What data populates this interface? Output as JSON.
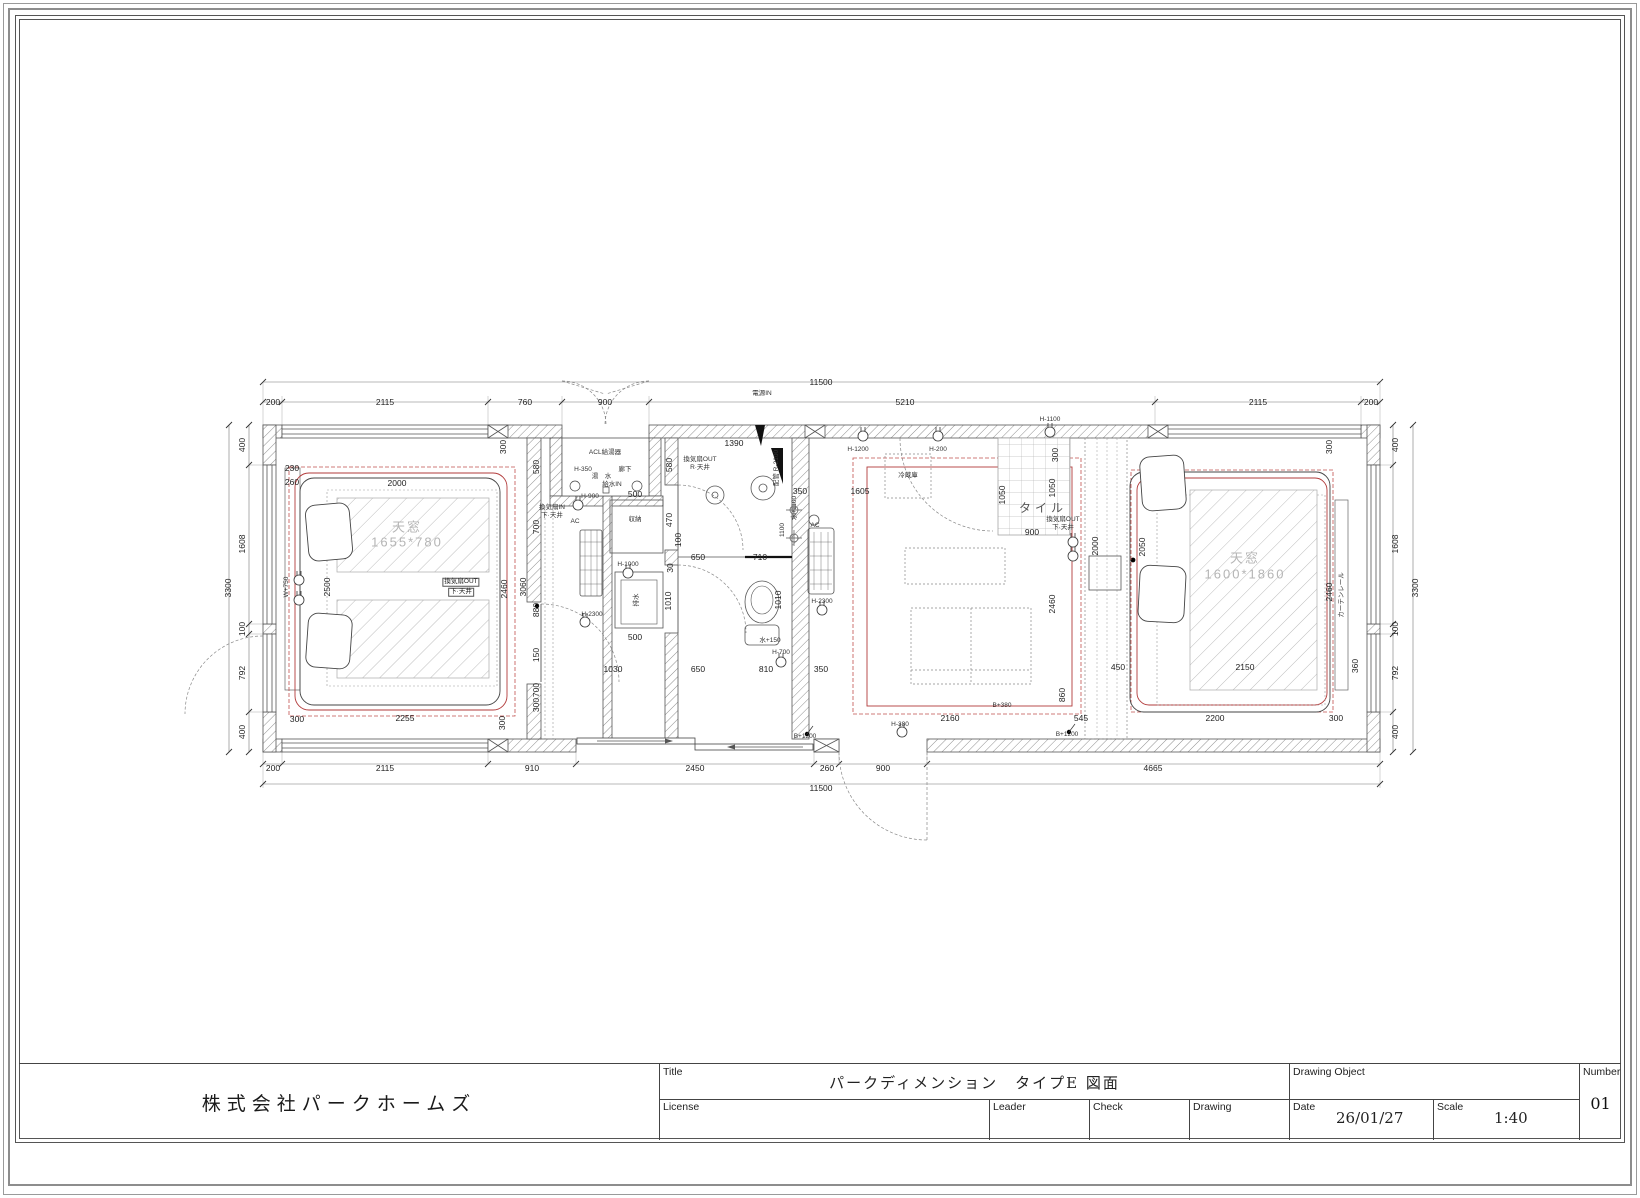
{
  "title_block": {
    "company": "株式会社パークホームズ",
    "title_label": "Title",
    "title": "パークディメンション　タイプE 図面",
    "license_label": "License",
    "leader_label": "Leader",
    "check_label": "Check",
    "drawing_label": "Drawing",
    "drawing_object_label": "Drawing Object",
    "date_label": "Date",
    "date_value": "26/01/27",
    "scale_label": "Scale",
    "scale_value": "1:40",
    "number_label": "Number",
    "number_value": "01"
  },
  "colors": {
    "wall_line": "#555555",
    "dim_text": "#222222",
    "ceiling_red": "#b23b3b",
    "glass_hatch": "#b9b9b9"
  },
  "plan": {
    "annotations": [
      {
        "t": "11500",
        "x": 616,
        "y": 22,
        "c": "d"
      },
      {
        "t": "200",
        "x": 68,
        "y": 42,
        "c": "d"
      },
      {
        "t": "2115",
        "x": 180,
        "y": 42,
        "c": "d"
      },
      {
        "t": "760",
        "x": 320,
        "y": 42,
        "c": "d"
      },
      {
        "t": "900",
        "x": 400,
        "y": 42,
        "c": "d"
      },
      {
        "t": "5210",
        "x": 700,
        "y": 42,
        "c": "d"
      },
      {
        "t": "2115",
        "x": 1053,
        "y": 42,
        "c": "d"
      },
      {
        "t": "200",
        "x": 1166,
        "y": 42,
        "c": "d"
      },
      {
        "t": "200",
        "x": 68,
        "y": 408,
        "c": "d"
      },
      {
        "t": "2115",
        "x": 180,
        "y": 408,
        "c": "d"
      },
      {
        "t": "910",
        "x": 327,
        "y": 408,
        "c": "d"
      },
      {
        "t": "2450",
        "x": 490,
        "y": 408,
        "c": "d"
      },
      {
        "t": "260",
        "x": 622,
        "y": 408,
        "c": "d"
      },
      {
        "t": "900",
        "x": 678,
        "y": 408,
        "c": "d"
      },
      {
        "t": "4665",
        "x": 948,
        "y": 408,
        "c": "d"
      },
      {
        "t": "11500",
        "x": 616,
        "y": 428,
        "c": "d"
      },
      {
        "t": "3300",
        "x": 23,
        "y": 228,
        "c": "dr"
      },
      {
        "t": "400",
        "x": 37,
        "y": 85,
        "c": "dr"
      },
      {
        "t": "1608",
        "x": 37,
        "y": 184,
        "c": "dr"
      },
      {
        "t": "100",
        "x": 37,
        "y": 269,
        "c": "dr"
      },
      {
        "t": "792",
        "x": 37,
        "y": 313,
        "c": "dr"
      },
      {
        "t": "400",
        "x": 37,
        "y": 372,
        "c": "dr"
      },
      {
        "t": "400",
        "x": 1190,
        "y": 85,
        "c": "dr"
      },
      {
        "t": "1608",
        "x": 1190,
        "y": 184,
        "c": "dr"
      },
      {
        "t": "100",
        "x": 1190,
        "y": 269,
        "c": "dr"
      },
      {
        "t": "792",
        "x": 1190,
        "y": 313,
        "c": "dr"
      },
      {
        "t": "400",
        "x": 1190,
        "y": 372,
        "c": "dr"
      },
      {
        "t": "3300",
        "x": 1210,
        "y": 228,
        "c": "dr"
      },
      {
        "t": "230",
        "x": 87,
        "y": 108,
        "c": "d"
      },
      {
        "t": "260",
        "x": 87,
        "y": 122,
        "c": "d"
      },
      {
        "t": "2000",
        "x": 192,
        "y": 123,
        "c": "d"
      },
      {
        "t": "2500",
        "x": 122,
        "y": 227,
        "c": "dr"
      },
      {
        "t": "2255",
        "x": 200,
        "y": 358,
        "c": "d"
      },
      {
        "t": "300",
        "x": 92,
        "y": 359,
        "c": "d"
      },
      {
        "t": "300",
        "x": 297,
        "y": 363,
        "c": "dr"
      },
      {
        "t": "300",
        "x": 298,
        "y": 87,
        "c": "dr"
      },
      {
        "t": "2460",
        "x": 299,
        "y": 229,
        "c": "dr"
      },
      {
        "t": "3060",
        "x": 318,
        "y": 227,
        "c": "dr"
      },
      {
        "t": "880",
        "x": 331,
        "y": 250,
        "c": "dr"
      },
      {
        "t": "580",
        "x": 331,
        "y": 107,
        "c": "dr"
      },
      {
        "t": "700",
        "x": 331,
        "y": 167,
        "c": "dr"
      },
      {
        "t": "150",
        "x": 331,
        "y": 295,
        "c": "dr"
      },
      {
        "t": "700",
        "x": 331,
        "y": 330,
        "c": "dr"
      },
      {
        "t": "300",
        "x": 331,
        "y": 345,
        "c": "dr"
      },
      {
        "t": "天窓",
        "x": 202,
        "y": 167,
        "c": "g"
      },
      {
        "t": "1655*780",
        "x": 202,
        "y": 182,
        "c": "g"
      },
      {
        "t": "換気扇OUT",
        "x": 256,
        "y": 222,
        "c": "b"
      },
      {
        "t": "下·天井",
        "x": 256,
        "y": 232,
        "c": "b"
      },
      {
        "t": "W+750",
        "x": 82,
        "y": 227,
        "c": "tr"
      },
      {
        "t": "ACL給湯器",
        "x": 400,
        "y": 93,
        "c": "t"
      },
      {
        "t": "H-350",
        "x": 378,
        "y": 110,
        "c": "t"
      },
      {
        "t": "湯",
        "x": 390,
        "y": 117,
        "c": "t"
      },
      {
        "t": "水",
        "x": 403,
        "y": 117,
        "c": "t"
      },
      {
        "t": "廊下",
        "x": 420,
        "y": 110,
        "c": "t"
      },
      {
        "t": "給水IN",
        "x": 407,
        "y": 125,
        "c": "t"
      },
      {
        "t": "電源IN",
        "x": 557,
        "y": 34,
        "c": "t"
      },
      {
        "t": "H-900",
        "x": 385,
        "y": 137,
        "c": "t"
      },
      {
        "t": "500",
        "x": 430,
        "y": 134,
        "c": "d"
      },
      {
        "t": "収納",
        "x": 430,
        "y": 160,
        "c": "t"
      },
      {
        "t": "470",
        "x": 464,
        "y": 160,
        "c": "dr"
      },
      {
        "t": "100",
        "x": 473,
        "y": 180,
        "c": "dr"
      },
      {
        "t": "580",
        "x": 464,
        "y": 105,
        "c": "dr"
      },
      {
        "t": "1390",
        "x": 529,
        "y": 83,
        "c": "d"
      },
      {
        "t": "換気扇OUT",
        "x": 495,
        "y": 100,
        "c": "t"
      },
      {
        "t": "R·天井",
        "x": 495,
        "y": 108,
        "c": "t"
      },
      {
        "t": "650",
        "x": 493,
        "y": 197,
        "c": "d"
      },
      {
        "t": "710",
        "x": 555,
        "y": 197,
        "c": "d"
      },
      {
        "t": "30",
        "x": 465,
        "y": 208,
        "c": "dr"
      },
      {
        "t": "1010",
        "x": 463,
        "y": 241,
        "c": "dr"
      },
      {
        "t": "1010",
        "x": 573,
        "y": 240,
        "c": "dr"
      },
      {
        "t": "H-1000",
        "x": 423,
        "y": 205,
        "c": "t"
      },
      {
        "t": "排水",
        "x": 432,
        "y": 240,
        "c": "tr"
      },
      {
        "t": "H-2300",
        "x": 387,
        "y": 255,
        "c": "t"
      },
      {
        "t": "500",
        "x": 430,
        "y": 277,
        "c": "d"
      },
      {
        "t": "AC",
        "x": 370,
        "y": 162,
        "c": "t"
      },
      {
        "t": "1030",
        "x": 408,
        "y": 309,
        "c": "d"
      },
      {
        "t": "650",
        "x": 493,
        "y": 309,
        "c": "d"
      },
      {
        "t": "810",
        "x": 561,
        "y": 309,
        "c": "d"
      },
      {
        "t": "350",
        "x": 616,
        "y": 309,
        "c": "d"
      },
      {
        "t": "水+150",
        "x": 565,
        "y": 281,
        "c": "t"
      },
      {
        "t": "H-700",
        "x": 576,
        "y": 293,
        "c": "t"
      },
      {
        "t": "H-380",
        "x": 695,
        "y": 365,
        "c": "t"
      },
      {
        "t": "B+1200",
        "x": 600,
        "y": 377,
        "c": "t"
      },
      {
        "t": "B+1200",
        "x": 862,
        "y": 375,
        "c": "t"
      },
      {
        "t": "水+1100",
        "x": 590,
        "y": 148,
        "c": "tr"
      },
      {
        "t": "1100",
        "x": 578,
        "y": 170,
        "c": "tr"
      },
      {
        "t": "配管 R-2100",
        "x": 572,
        "y": 108,
        "c": "tr"
      },
      {
        "t": "AC",
        "x": 610,
        "y": 166,
        "c": "t"
      },
      {
        "t": "H-2300",
        "x": 617,
        "y": 242,
        "c": "t"
      },
      {
        "t": "換気扇IN",
        "x": 347,
        "y": 148,
        "c": "t"
      },
      {
        "t": "下·天井",
        "x": 347,
        "y": 156,
        "c": "t"
      },
      {
        "t": "H-1200",
        "x": 653,
        "y": 90,
        "c": "t"
      },
      {
        "t": "H-200",
        "x": 733,
        "y": 90,
        "c": "t"
      },
      {
        "t": "冷蔵庫",
        "x": 703,
        "y": 116,
        "c": "t"
      },
      {
        "t": "350",
        "x": 595,
        "y": 131,
        "c": "d"
      },
      {
        "t": "1605",
        "x": 655,
        "y": 131,
        "c": "d"
      },
      {
        "t": "1050",
        "x": 797,
        "y": 135,
        "c": "dr"
      },
      {
        "t": "1050",
        "x": 847,
        "y": 128,
        "c": "dr"
      },
      {
        "t": "300",
        "x": 850,
        "y": 95,
        "c": "dr"
      },
      {
        "t": "900",
        "x": 827,
        "y": 172,
        "c": "d"
      },
      {
        "t": "タイル",
        "x": 838,
        "y": 148,
        "c": "k"
      },
      {
        "t": "2460",
        "x": 847,
        "y": 244,
        "c": "dr"
      },
      {
        "t": "2160",
        "x": 745,
        "y": 358,
        "c": "d"
      },
      {
        "t": "545",
        "x": 876,
        "y": 358,
        "c": "d"
      },
      {
        "t": "860",
        "x": 857,
        "y": 335,
        "c": "dr"
      },
      {
        "t": "天窓",
        "x": 1040,
        "y": 198,
        "c": "g"
      },
      {
        "t": "1600*1860",
        "x": 1040,
        "y": 214,
        "c": "g"
      },
      {
        "t": "300",
        "x": 1124,
        "y": 87,
        "c": "dr"
      },
      {
        "t": "2460",
        "x": 1124,
        "y": 232,
        "c": "dr"
      },
      {
        "t": "2050",
        "x": 937,
        "y": 187,
        "c": "dr"
      },
      {
        "t": "2000",
        "x": 890,
        "y": 186,
        "c": "dr"
      },
      {
        "t": "450",
        "x": 913,
        "y": 307,
        "c": "d"
      },
      {
        "t": "2150",
        "x": 1040,
        "y": 307,
        "c": "d"
      },
      {
        "t": "360",
        "x": 1150,
        "y": 306,
        "c": "dr"
      },
      {
        "t": "2200",
        "x": 1010,
        "y": 358,
        "c": "d"
      },
      {
        "t": "300",
        "x": 1131,
        "y": 358,
        "c": "d"
      },
      {
        "t": "H-1100",
        "x": 845,
        "y": 60,
        "c": "t"
      },
      {
        "t": "換気扇OUT",
        "x": 858,
        "y": 160,
        "c": "t"
      },
      {
        "t": "下·天井",
        "x": 858,
        "y": 168,
        "c": "t"
      },
      {
        "t": "カーテンレール",
        "x": 1137,
        "y": 235,
        "c": "tr"
      },
      {
        "t": "B+380",
        "x": 797,
        "y": 346,
        "c": "t"
      }
    ]
  }
}
